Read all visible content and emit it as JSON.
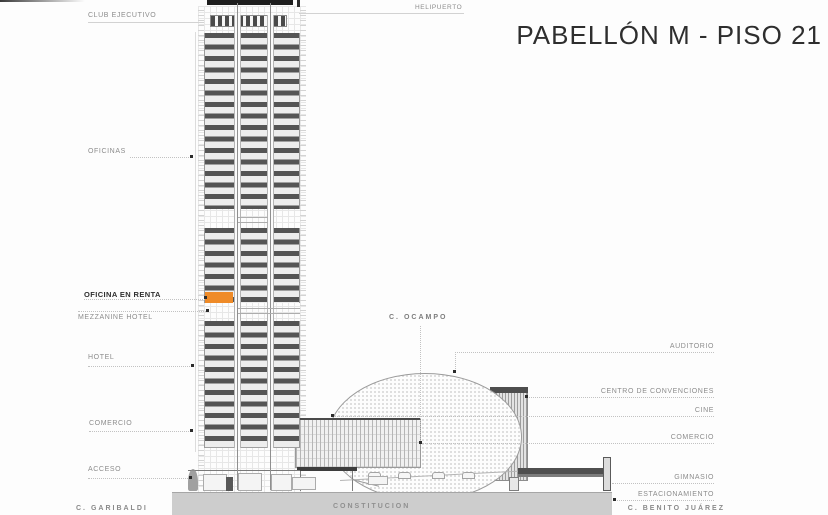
{
  "title": "PABELLÓN M - PISO 21",
  "building_labels_left": {
    "club_ejecutivo": "CLUB EJECUTIVO",
    "oficinas": "OFICINAS",
    "oficina_en_renta": "OFICINA EN RENTA",
    "mezzanine_hotel": "MEZZANINE HOTEL",
    "hotel": "HOTEL",
    "comercio": "COMERCIO",
    "acceso": "ACCESO"
  },
  "building_labels_right": {
    "helipuerto": "HELIPUERTO",
    "auditorio": "AUDITORIO",
    "centro_de_convenciones": "CENTRO DE CONVENCIONES",
    "cine": "CINE",
    "comercio": "COMERCIO",
    "gimnasio": "GIMNASIO",
    "estacionamiento": "ESTACIONAMIENTO"
  },
  "streets": {
    "garibaldi": "C. GARIBALDI",
    "constitucion": "CONSTITUCION",
    "ocampo": "C. OCAMPO",
    "benito_juarez": "C. BENITO JUÁREZ"
  },
  "colors": {
    "highlight_orange": "#EF8B28"
  }
}
